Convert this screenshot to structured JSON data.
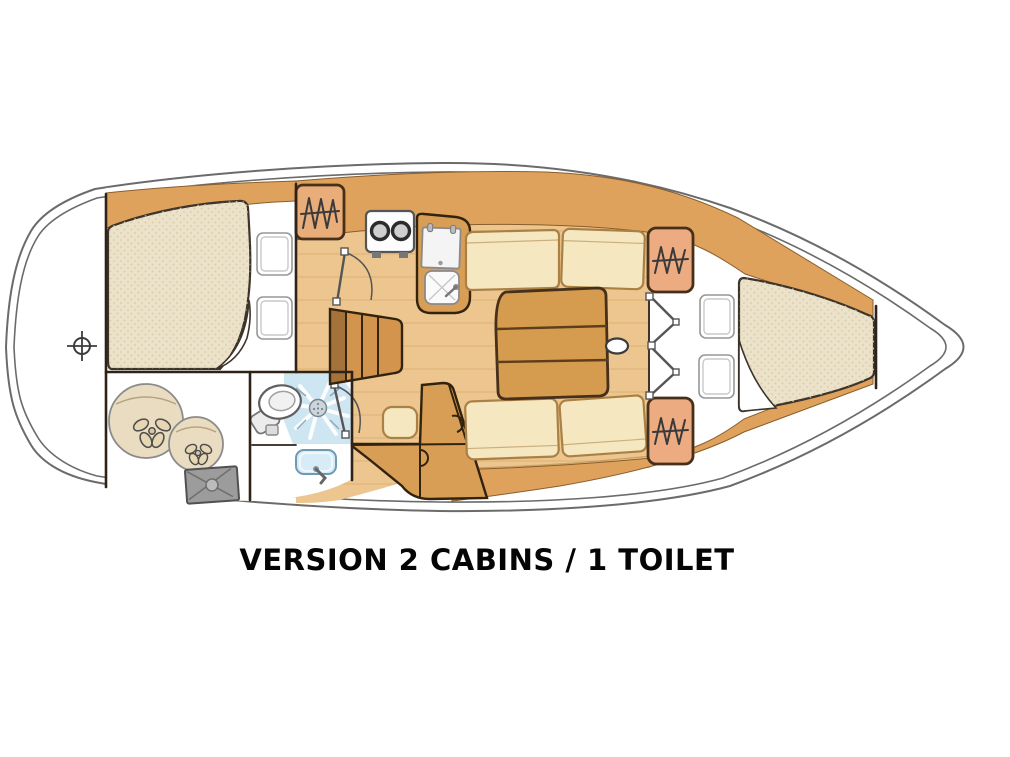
{
  "caption": {
    "text": "VERSION 2 CABINS / 1 TOILET"
  },
  "plan": {
    "type": "sailboat-interior-floor-plan",
    "orientation": "bow-right-stern-left",
    "areas": [
      "aft-cabin-double-berth",
      "storage-locker-with-fenders",
      "head-toilet-shower-sink",
      "galley-stove-fridge-sink",
      "companionway-steps",
      "salon-settees-table",
      "chart-table",
      "forward-v-berth-cabin",
      "anchor-locker-bow"
    ],
    "icons": [
      "stern-datum-crosshair-icon",
      "fender-icon",
      "deck-hatch-icon",
      "toilet-icon",
      "shower-drain-icon",
      "sink-icon",
      "hanging-locker-icon",
      "stove-burners-icon",
      "fridge-icon",
      "steps-icon",
      "door-swing-icon",
      "bifold-door-icon",
      "pillow-icon",
      "mattress-icon",
      "table-icon",
      "mast-icon"
    ]
  },
  "colors": {
    "background": "#ffffff",
    "hull_line": "#6b6b6b",
    "wall_line": "#2f2318",
    "wood_band": "#dfa25d",
    "floor_wood": "#ecc68e",
    "furniture_wood": "#d99e55",
    "steps_wood": "#d3954e",
    "table_wood": "#d59c50",
    "cushion": "#f5e8c1",
    "mattress": "#ebe2c9",
    "pillow": "#ffffff",
    "locker_galley": "#e9ad79",
    "locker_forward": "#ecab81",
    "shower_blue": "#cee5f2",
    "sink_blue": "#d8ecf8",
    "hatch_gray": "#9c9c9c",
    "fender": "#e9dcc0",
    "caption": "#050505"
  }
}
